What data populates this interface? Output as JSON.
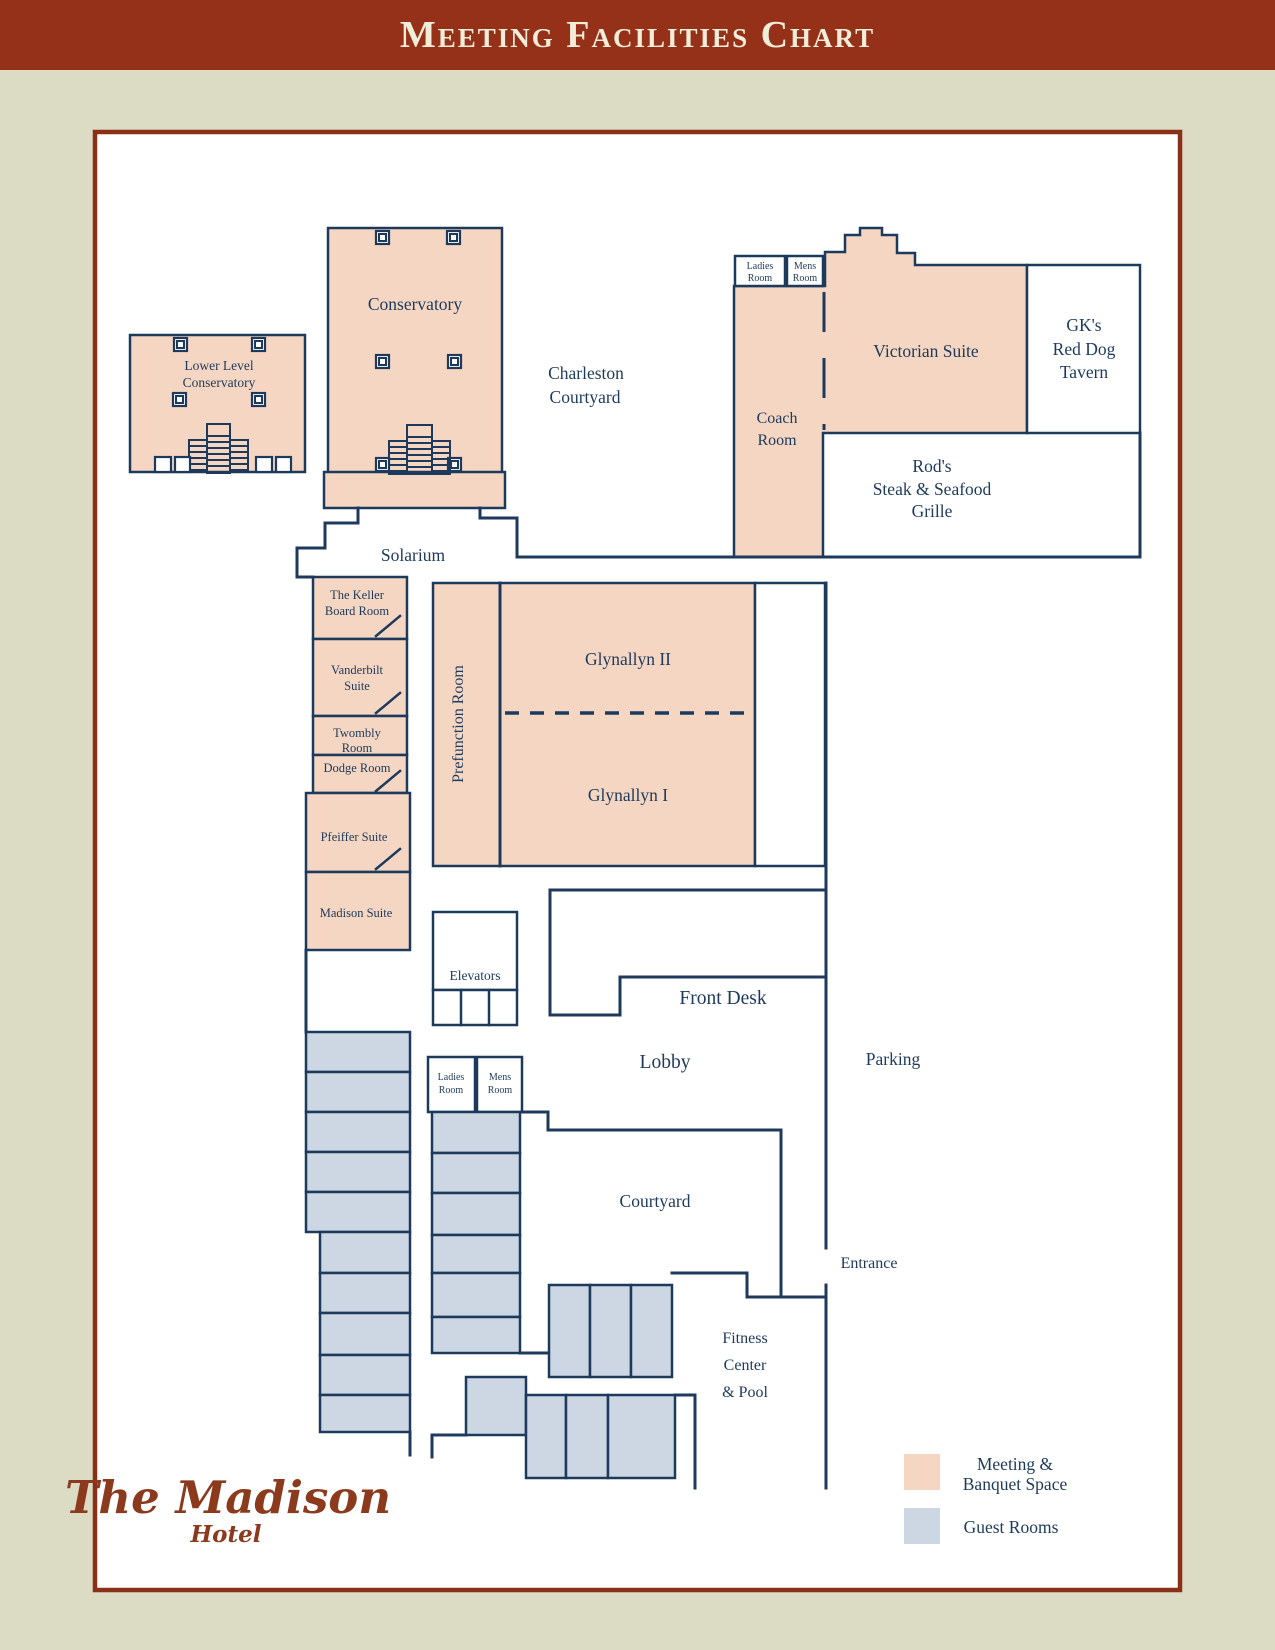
{
  "title": "Meeting Facilities Chart",
  "colors": {
    "banner": "#963119",
    "plan_border": "#8a3016",
    "background": "#dbdcc3",
    "meeting_space": "#f5d6c2",
    "guest_rooms": "#cdd7e3",
    "lines_text": "#1d3a5c",
    "logo": "#8c3a1d"
  },
  "labels": {
    "lower_level": [
      "Lower Level",
      "Conservatory"
    ],
    "conservatory": "Conservatory",
    "charleston": [
      "Charleston",
      "Courtyard"
    ],
    "ladies": [
      "Ladies",
      "Room"
    ],
    "mens": [
      "Mens",
      "Room"
    ],
    "victorian": "Victorian Suite",
    "gk": [
      "GK's",
      "Red Dog",
      "Tavern"
    ],
    "coach": [
      "Coach",
      "Room"
    ],
    "rods": [
      "Rod's",
      "Steak & Seafood",
      "Grille"
    ],
    "solarium": "Solarium",
    "keller": [
      "The Keller",
      "Board Room"
    ],
    "vanderbilt": [
      "Vanderbilt",
      "Suite"
    ],
    "twombly": [
      "Twombly",
      "Room"
    ],
    "dodge": "Dodge Room",
    "pfeiffer": "Pfeiffer Suite",
    "madison_suite": "Madison Suite",
    "prefunction": "Prefunction Room",
    "glynallyn2": "Glynallyn II",
    "glynallyn1": "Glynallyn I",
    "elevators": "Elevators",
    "front_desk": "Front Desk",
    "lobby": "Lobby",
    "parking": "Parking",
    "courtyard": "Courtyard",
    "entrance": "Entrance",
    "fitness": [
      "Fitness",
      "Center",
      "& Pool"
    ]
  },
  "legend": {
    "meeting": [
      "Meeting &",
      "Banquet Space"
    ],
    "guest": "Guest Rooms"
  },
  "logo": {
    "name": "The Madison",
    "type": "Hotel"
  }
}
